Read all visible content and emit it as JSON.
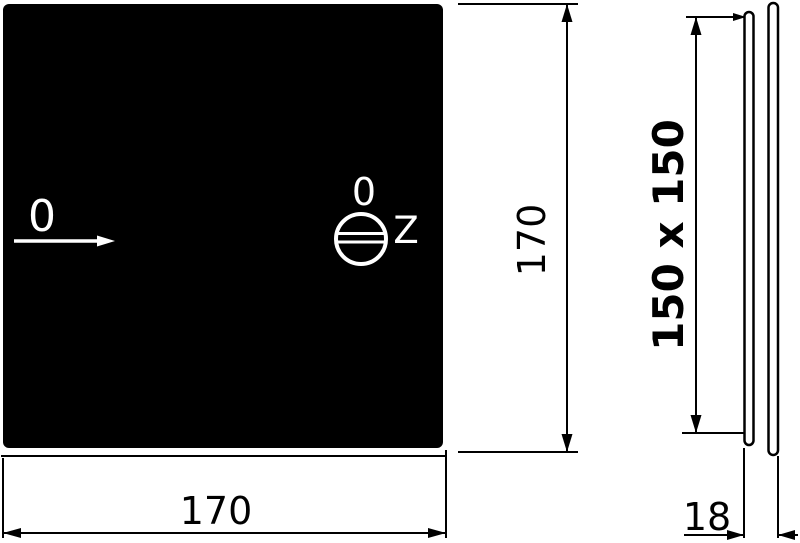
{
  "drawing": {
    "type": "technical-dimension-drawing",
    "front_view": {
      "plate_marker_zero": "0",
      "screw_marker_zero": "0",
      "screw_zone_label": "Z"
    },
    "dimensions": {
      "width": "170",
      "height": "170",
      "inner_cutout": "150 x 150",
      "depth": "18"
    },
    "icons": {
      "screw_head": "slotted-screw-head-icon",
      "zero_arrow": "right-arrow-icon"
    },
    "colors": {
      "paper": "#ffffff",
      "ink": "#000000",
      "plate_fill": "#000000",
      "plate_ink": "#ffffff"
    }
  }
}
